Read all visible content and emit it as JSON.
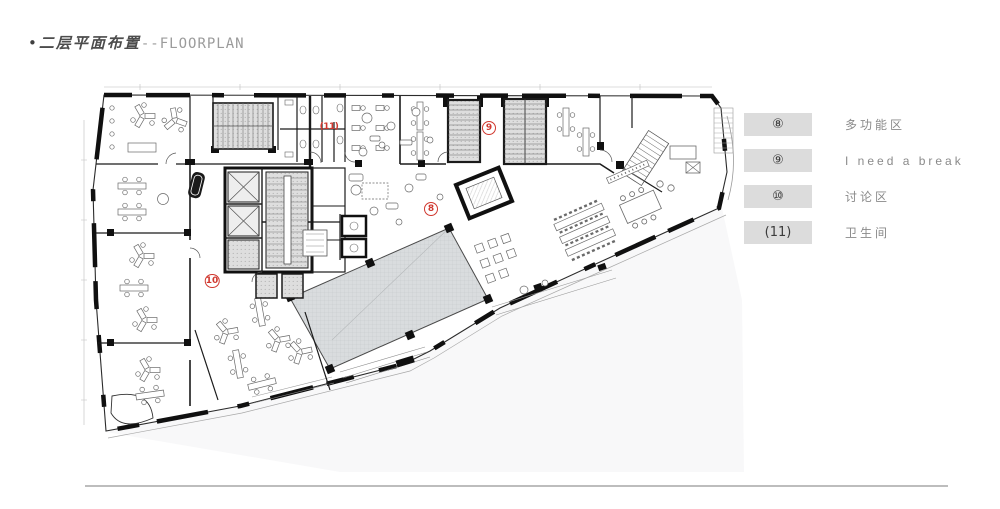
{
  "slide": {
    "title": {
      "bullet": "•",
      "cn": "二层平面布置",
      "en": "--FLOORPLAN"
    }
  },
  "legend": {
    "box_color": "#dcdcdc",
    "label_color": "#8a8a8a",
    "items": [
      {
        "key": "⑧",
        "label": "多功能区"
      },
      {
        "key": "⑨",
        "label": "I need a break"
      },
      {
        "key": "⑩",
        "label": "讨论区"
      },
      {
        "key": "(11)",
        "label": "卫生间"
      }
    ]
  },
  "plan": {
    "marker_color": "#d0382f",
    "markers": [
      {
        "text": "(11)",
        "x": 329,
        "y": 127,
        "ring": false
      },
      {
        "text": "9",
        "x": 489,
        "y": 128,
        "ring": true
      },
      {
        "text": "8",
        "x": 431,
        "y": 209,
        "ring": true
      },
      {
        "text": "10",
        "x": 212,
        "y": 281,
        "ring": true
      }
    ]
  }
}
